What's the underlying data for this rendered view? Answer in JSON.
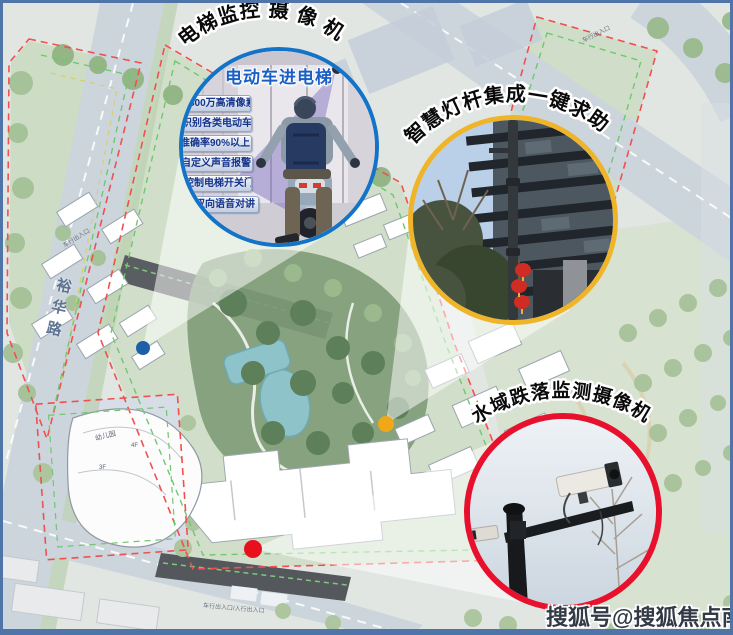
{
  "callouts": {
    "elevator": {
      "arc_label": "电梯监控 摄 像 机",
      "title": "电动车进电梯",
      "features": [
        "500万高清像素",
        "识别各类电动车",
        "准确率90%以上",
        "自定义声音报警",
        "控制电梯开关门",
        "双向语音对讲"
      ],
      "ring_color": "#1273c8",
      "marker_color": "#1f5fa8"
    },
    "lightpole": {
      "arc_label": "智慧灯杆集成一键求助",
      "ring_color": "#f0b429",
      "marker_color": "#f0a818"
    },
    "water": {
      "arc_label": "水域跌落监测摄像机",
      "ring_color": "#e8112d",
      "marker_color": "#e8101c"
    }
  },
  "map": {
    "road_name": "裕华路",
    "kindergarten": {
      "name": "幼儿园",
      "floors_a": "4F",
      "floors_b": "3F"
    },
    "entrances": [
      "车行出入口",
      "车行出入口/人行出入口",
      "车行出入口"
    ],
    "boundary_red": "#f05050",
    "boundary_green": "#6fc86f",
    "boundary_yellow": "#d6ce72"
  },
  "watermark": {
    "text": "搜狐号@搜狐焦点南平站"
  },
  "frame": {
    "border_color": "#4f74a8"
  }
}
